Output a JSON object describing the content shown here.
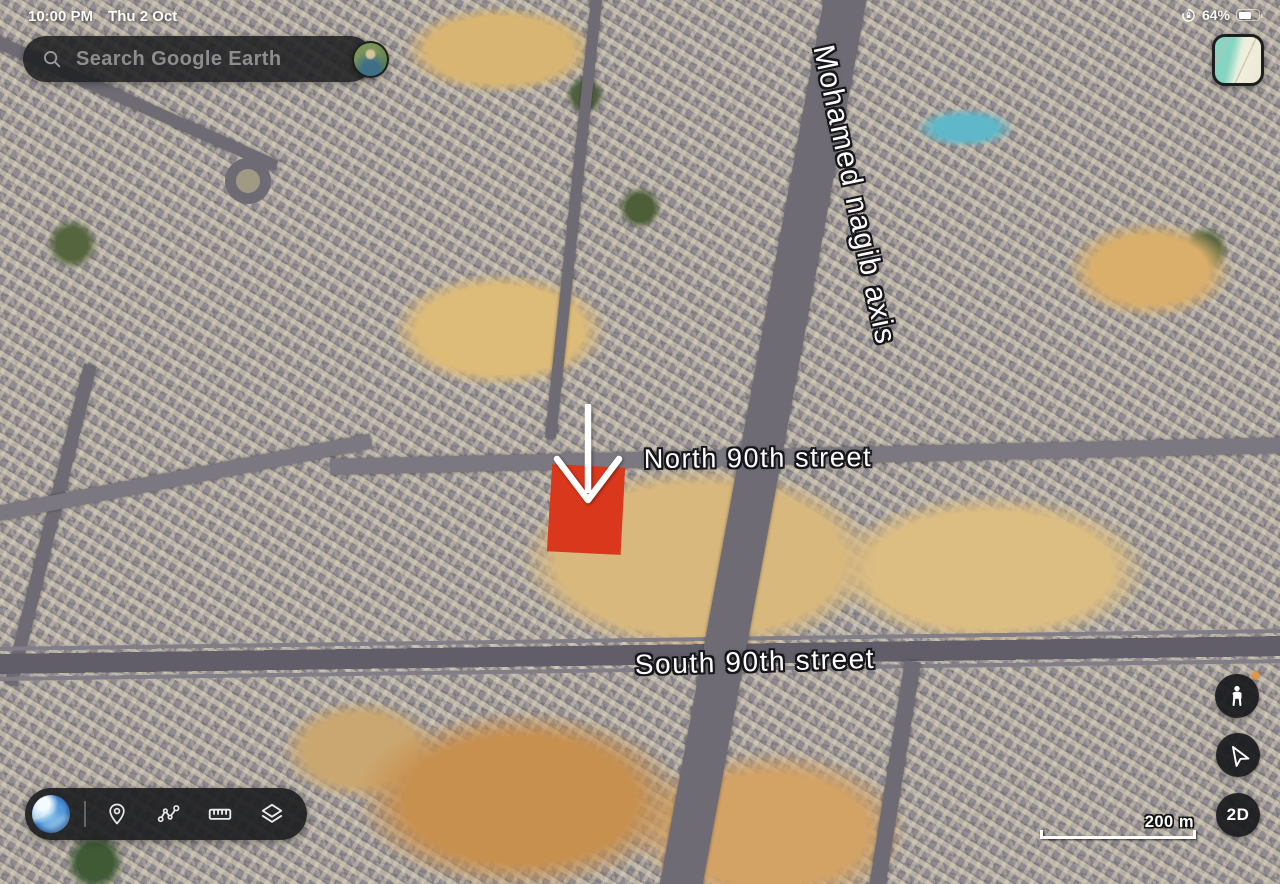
{
  "status_bar": {
    "time": "10:00 PM",
    "date": "Thu 2 Oct",
    "battery_percent": "64%",
    "icons": {
      "rotation_lock": "lock-in-circular-arrow",
      "battery": "battery-filled"
    }
  },
  "search_bar": {
    "placeholder": "Search Google Earth",
    "icons": {
      "search": "magnifier",
      "account": "profile-photo-avatar"
    }
  },
  "map": {
    "labels": [
      {
        "id": "north-90th-street",
        "text": "North 90th street"
      },
      {
        "id": "south-90th-street",
        "text": "South 90th street"
      },
      {
        "id": "mohamed-nagib-axis",
        "text": "Mohamed nagib axis"
      }
    ],
    "marker": {
      "shape": "red-square",
      "color": "#d9381c",
      "pointer": "white-down-arrow"
    }
  },
  "controls": {
    "view_toggle_label": "2D",
    "scale_label": "200 m",
    "icons": {
      "pegman": "street-view-person",
      "navigation": "tilted-location-arrow",
      "minimap": "map-style-thumbnail"
    }
  },
  "toolbar": {
    "icons": {
      "logo": "google-earth-globe",
      "pin": "location-pin-outline",
      "path": "connected-dots-route",
      "ruler": "measure-ruler",
      "layers": "stacked-layers"
    }
  },
  "colors": {
    "marker_red": "#d9381c",
    "panel_dark": "#1d1e21",
    "earth_blue": "#3576c2",
    "sand": "#d8b87d",
    "road_gray": "#6e6b74"
  }
}
